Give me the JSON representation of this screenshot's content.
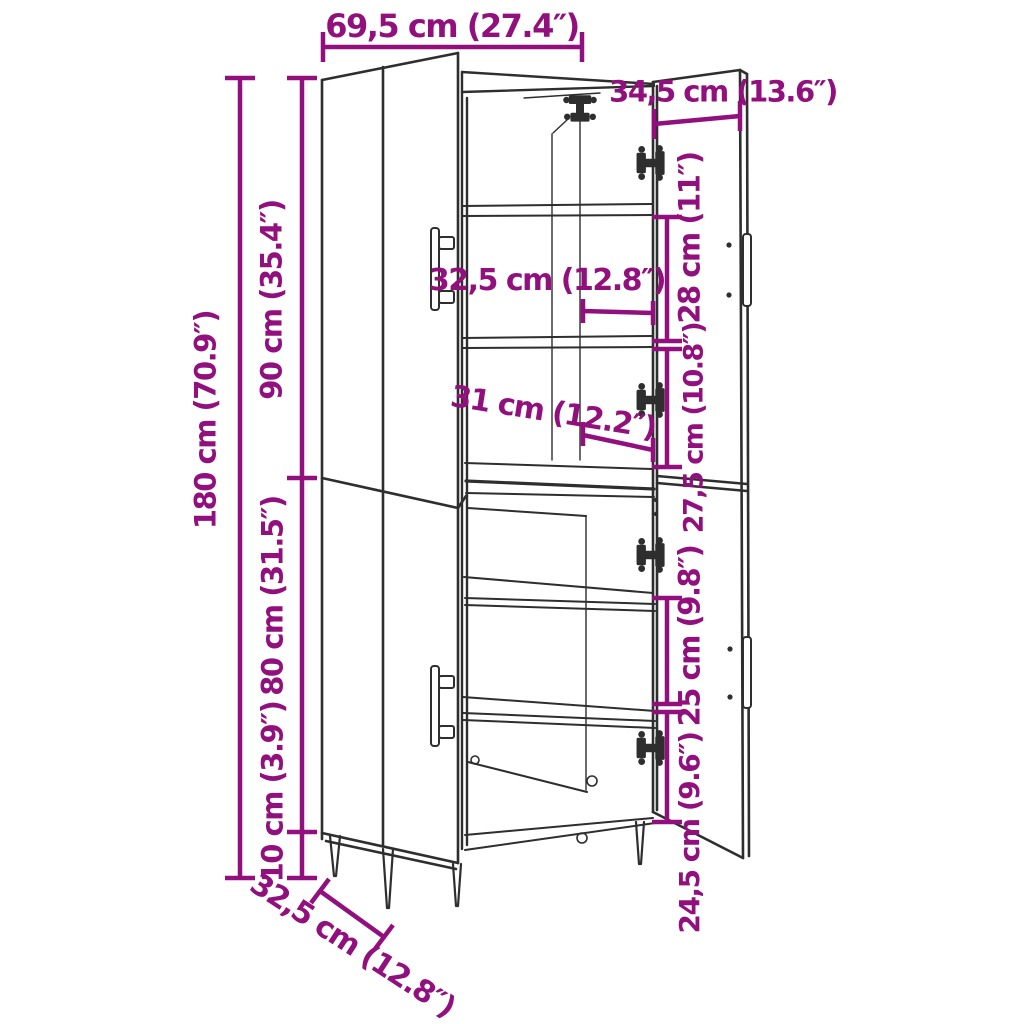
{
  "diagram_type": "furniture-dimension-diagram",
  "subject": "tall cabinet with two sections, open right doors and interior shelves",
  "colors": {
    "dimension_accent": "#91107D",
    "drawing_line": "#2E2E2E",
    "background": "#FFFFFF"
  },
  "labels": {
    "width_top": "69,5 cm (27.4″)",
    "door_width": "34,5 cm (13.6″)",
    "height_total": "180 cm (70.9″)",
    "height_upper": "90 cm (35.4″)",
    "height_lower": "80 cm (31.5″)",
    "height_legs": "10 cm (3.9″)",
    "inner_width_upper": "32,5 cm (12.8″)",
    "inner_width_lower": "31 cm (12.2″)",
    "compartment_top": "28 cm (11″)",
    "compartment_upper_mid": "27,5 cm (10.8″)",
    "compartment_lower_mid": "25 cm (9.8″)",
    "compartment_bottom": "24,5 cm (9.6″)",
    "depth": "32,5 cm (12.8″)"
  }
}
